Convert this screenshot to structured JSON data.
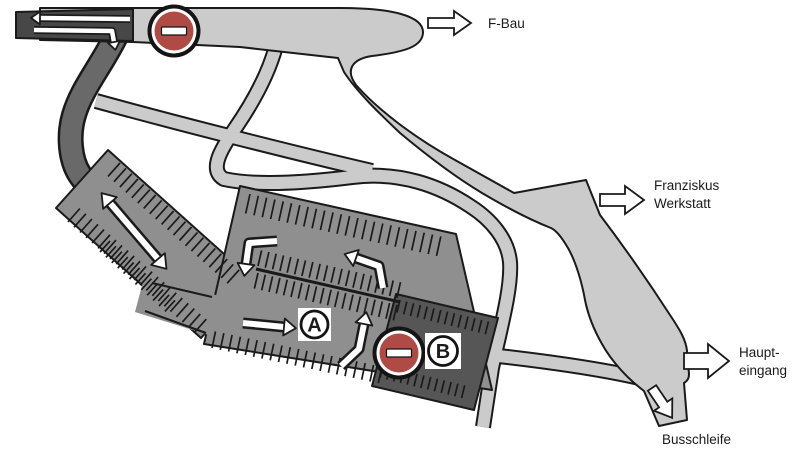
{
  "map": {
    "labels": {
      "f_bau": "F-Bau",
      "franziskus_line1": "Franziskus",
      "franziskus_line2": "Werkstatt",
      "haupteingang_line1": "Haupt-",
      "haupteingang_line2": "eingang",
      "busschleife": "Busschleife",
      "parking_area_a": "A",
      "parking_area_b": "B"
    },
    "colors": {
      "background": "#ffffff",
      "road_light": "#cbcbcb",
      "road_outline": "#1a1a1a",
      "access_road_dark": "#696969",
      "exit_strip_dark": "#474747",
      "parking_lot_medium": "#8f8f8f",
      "parking_lot_dark": "#565656",
      "no_entry_red": "#b04a45"
    }
  }
}
